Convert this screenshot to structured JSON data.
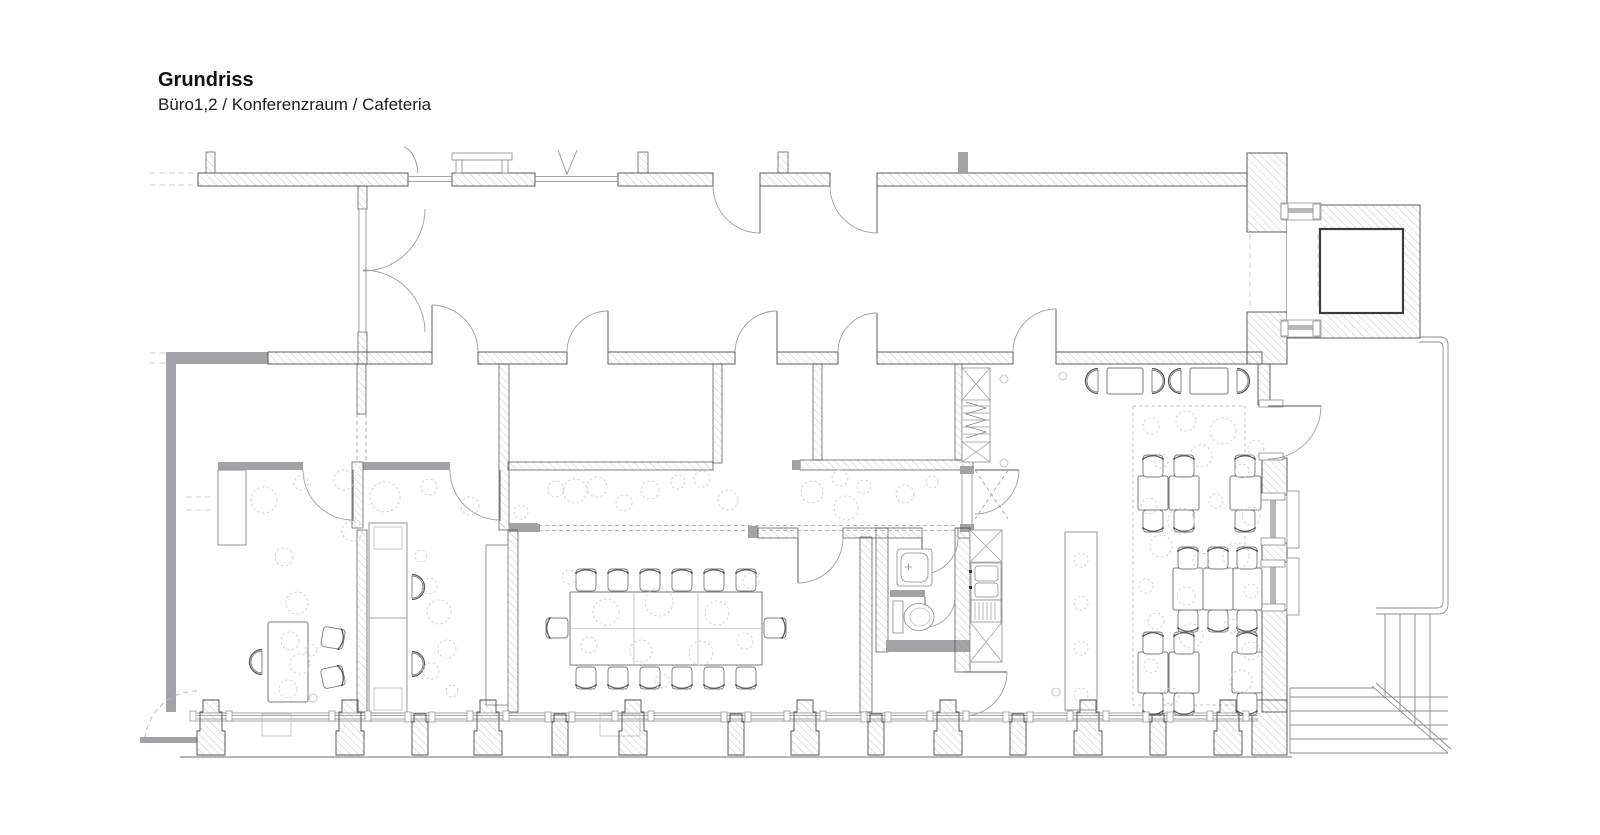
{
  "header": {
    "title": "Grundriss",
    "subtitle": "Büro1,2 / Konferenzraum / Cafeteria"
  },
  "drawing": {
    "type": "architectural-floor-plan",
    "rooms_in_subtitle": [
      "Büro 1",
      "Büro 2",
      "Konferenzraum",
      "Cafeteria"
    ]
  },
  "colors": {
    "wall_gray": "#a3a3a5",
    "hatch_line": "#b8b8b8",
    "line_dark": "#4d4d4d",
    "line_mid": "#8a8a8a",
    "dashed_decor": "#cfcfcf",
    "background": "#ffffff"
  }
}
